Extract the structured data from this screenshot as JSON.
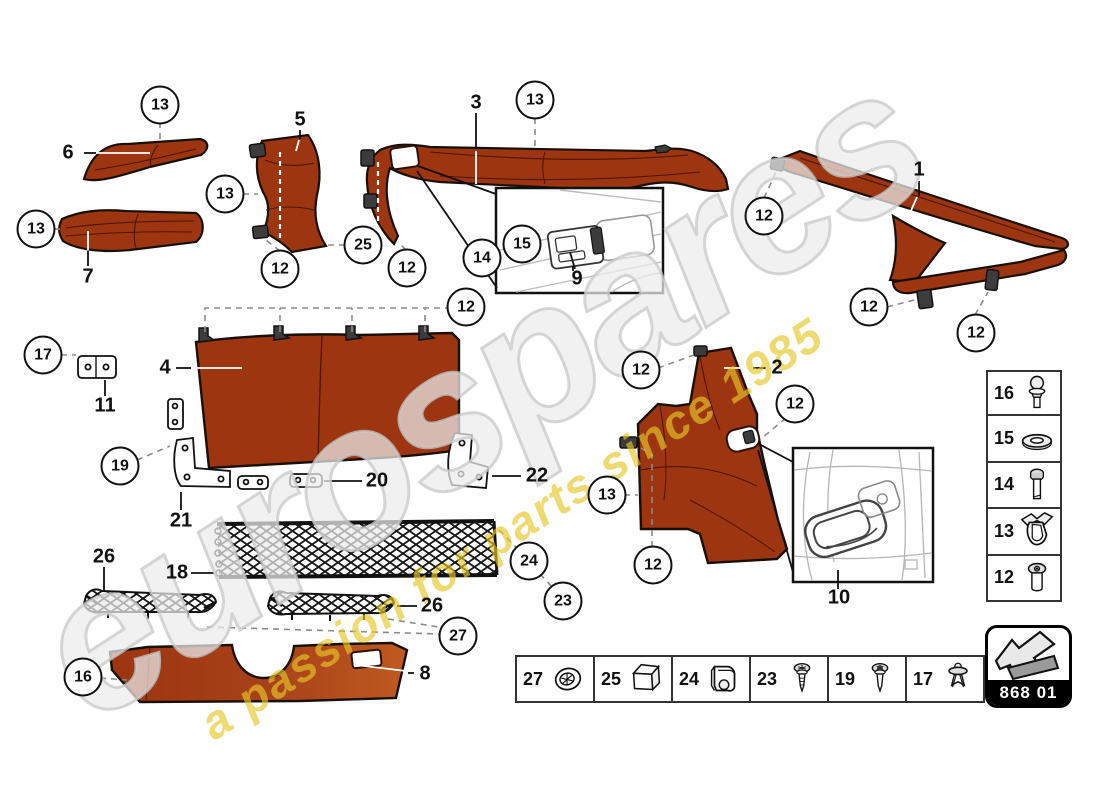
{
  "watermark": {
    "brand": "eurospares",
    "tagline": "a passion for parts since 1985"
  },
  "page_code": {
    "label": "868 01"
  },
  "colors": {
    "part_orange": "#9C3510",
    "part_orange_light": "#C05A20",
    "watermark_yellow": "#E8C628",
    "outline": "#181008"
  },
  "callouts": [
    {
      "n": "13",
      "x": 160,
      "y": 105
    },
    {
      "n": "13",
      "x": 535,
      "y": 100
    },
    {
      "n": "13",
      "x": 225,
      "y": 194
    },
    {
      "n": "13",
      "x": 36,
      "y": 229
    },
    {
      "n": "25",
      "x": 363,
      "y": 245
    },
    {
      "n": "12",
      "x": 280,
      "y": 269
    },
    {
      "n": "12",
      "x": 407,
      "y": 268
    },
    {
      "n": "15",
      "x": 522,
      "y": 244
    },
    {
      "n": "14",
      "x": 482,
      "y": 258
    },
    {
      "n": "12",
      "x": 764,
      "y": 216
    },
    {
      "n": "12",
      "x": 869,
      "y": 307
    },
    {
      "n": "12",
      "x": 976,
      "y": 333
    },
    {
      "n": "12",
      "x": 466,
      "y": 307
    },
    {
      "n": "12",
      "x": 641,
      "y": 370
    },
    {
      "n": "12",
      "x": 795,
      "y": 404
    },
    {
      "n": "13",
      "x": 607,
      "y": 495
    },
    {
      "n": "12",
      "x": 653,
      "y": 565
    },
    {
      "n": "17",
      "x": 43,
      "y": 355
    },
    {
      "n": "19",
      "x": 120,
      "y": 466
    },
    {
      "n": "24",
      "x": 529,
      "y": 561
    },
    {
      "n": "23",
      "x": 563,
      "y": 601
    },
    {
      "n": "27",
      "x": 458,
      "y": 636
    },
    {
      "n": "16",
      "x": 83,
      "y": 677
    }
  ],
  "labels": [
    {
      "n": "6",
      "x": 68,
      "y": 153
    },
    {
      "n": "5",
      "x": 300,
      "y": 120
    },
    {
      "n": "3",
      "x": 476,
      "y": 103
    },
    {
      "n": "1",
      "x": 919,
      "y": 170
    },
    {
      "n": "7",
      "x": 88,
      "y": 277
    },
    {
      "n": "9",
      "x": 577,
      "y": 279
    },
    {
      "n": "4",
      "x": 165,
      "y": 368
    },
    {
      "n": "11",
      "x": 105,
      "y": 406
    },
    {
      "n": "2",
      "x": 777,
      "y": 368
    },
    {
      "n": "21",
      "x": 181,
      "y": 521
    },
    {
      "n": "20",
      "x": 377,
      "y": 481
    },
    {
      "n": "22",
      "x": 537,
      "y": 476
    },
    {
      "n": "10",
      "x": 839,
      "y": 598
    },
    {
      "n": "26",
      "x": 104,
      "y": 557
    },
    {
      "n": "18",
      "x": 177,
      "y": 573
    },
    {
      "n": "26",
      "x": 432,
      "y": 606
    },
    {
      "n": "8",
      "x": 425,
      "y": 674
    }
  ],
  "side_legend": {
    "items": [
      {
        "n": "16",
        "icon": "ball-stud-icon"
      },
      {
        "n": "15",
        "icon": "washer-icon"
      },
      {
        "n": "14",
        "icon": "bolt-icon"
      },
      {
        "n": "13",
        "icon": "spring-clip-icon"
      },
      {
        "n": "12",
        "icon": "round-screw-icon"
      }
    ]
  },
  "bottom_legend": {
    "items": [
      {
        "n": "27",
        "icon": "grommet-icon"
      },
      {
        "n": "25",
        "icon": "cube-icon"
      },
      {
        "n": "24",
        "icon": "clamp-bracket-icon"
      },
      {
        "n": "23",
        "icon": "screw-icon"
      },
      {
        "n": "19",
        "icon": "screw-icon"
      },
      {
        "n": "17",
        "icon": "push-rivet-icon"
      }
    ]
  }
}
